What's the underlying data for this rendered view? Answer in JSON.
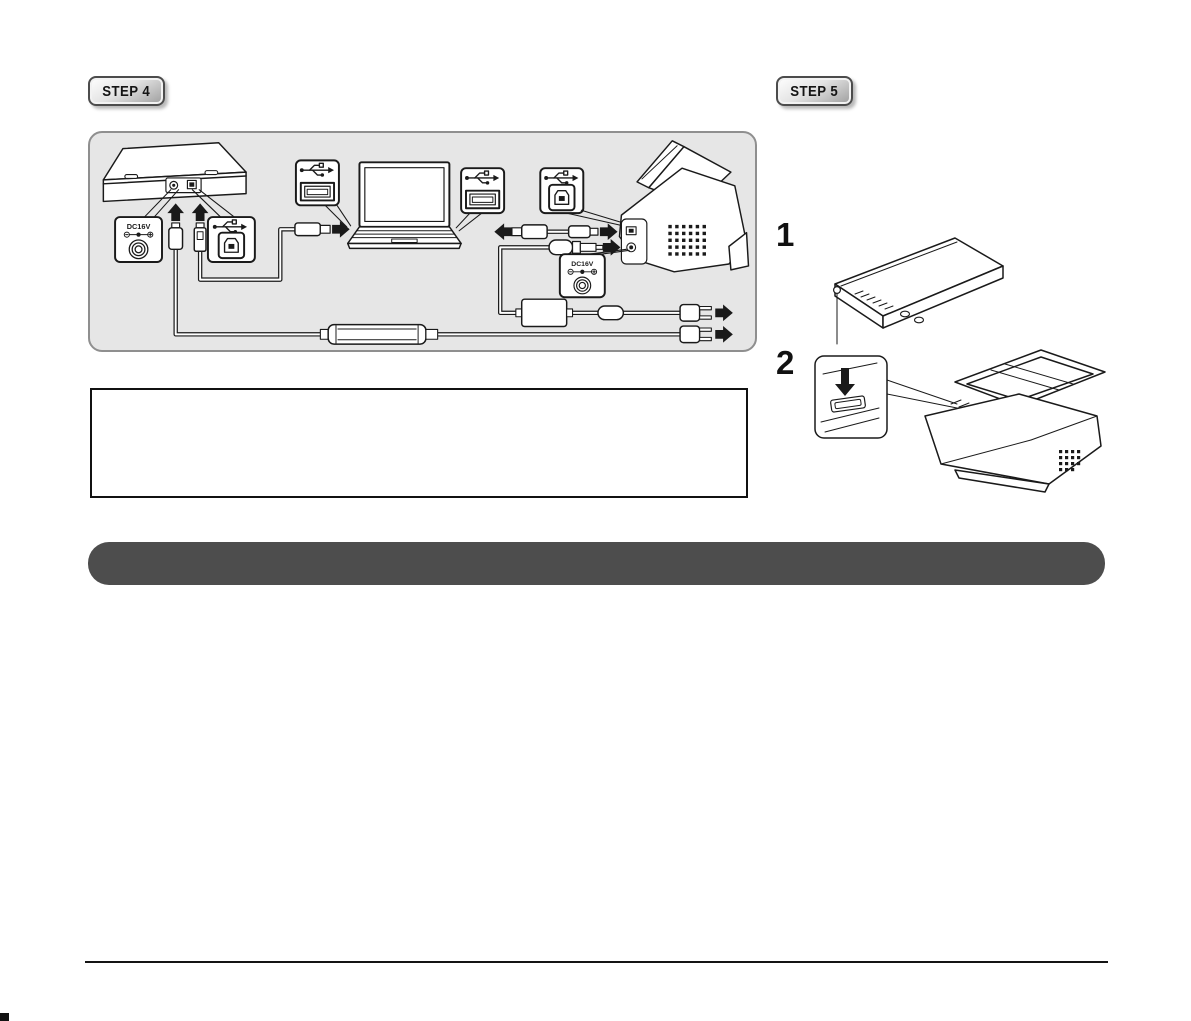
{
  "badges": {
    "step4": "STEP 4",
    "step5": "STEP 5"
  },
  "connection_diagram": {
    "dc16v_left": "DC16V",
    "dc16v_right": "DC16V",
    "icons": {
      "usb_icon": "usb-trident symbol",
      "usb_a_port_icon": "horizontal USB type-A receptacle",
      "usb_b_port_icon": "square USB type-B receptacle",
      "power_jack_icon": "concentric-circle DC jack",
      "polarity_icon": "minus-center-plus DC polarity symbol",
      "direction_arrow_icon": "solid black block arrow"
    }
  },
  "instruction_steps": {
    "step1_number": "1",
    "step2_number": "2"
  },
  "colors": {
    "panel_background": "#e6e6e6",
    "panel_border": "#8f8f8f",
    "section_bar": "#4d4d4d",
    "badge_border": "#4c4c4c",
    "line_art": "#1a1a1a"
  }
}
